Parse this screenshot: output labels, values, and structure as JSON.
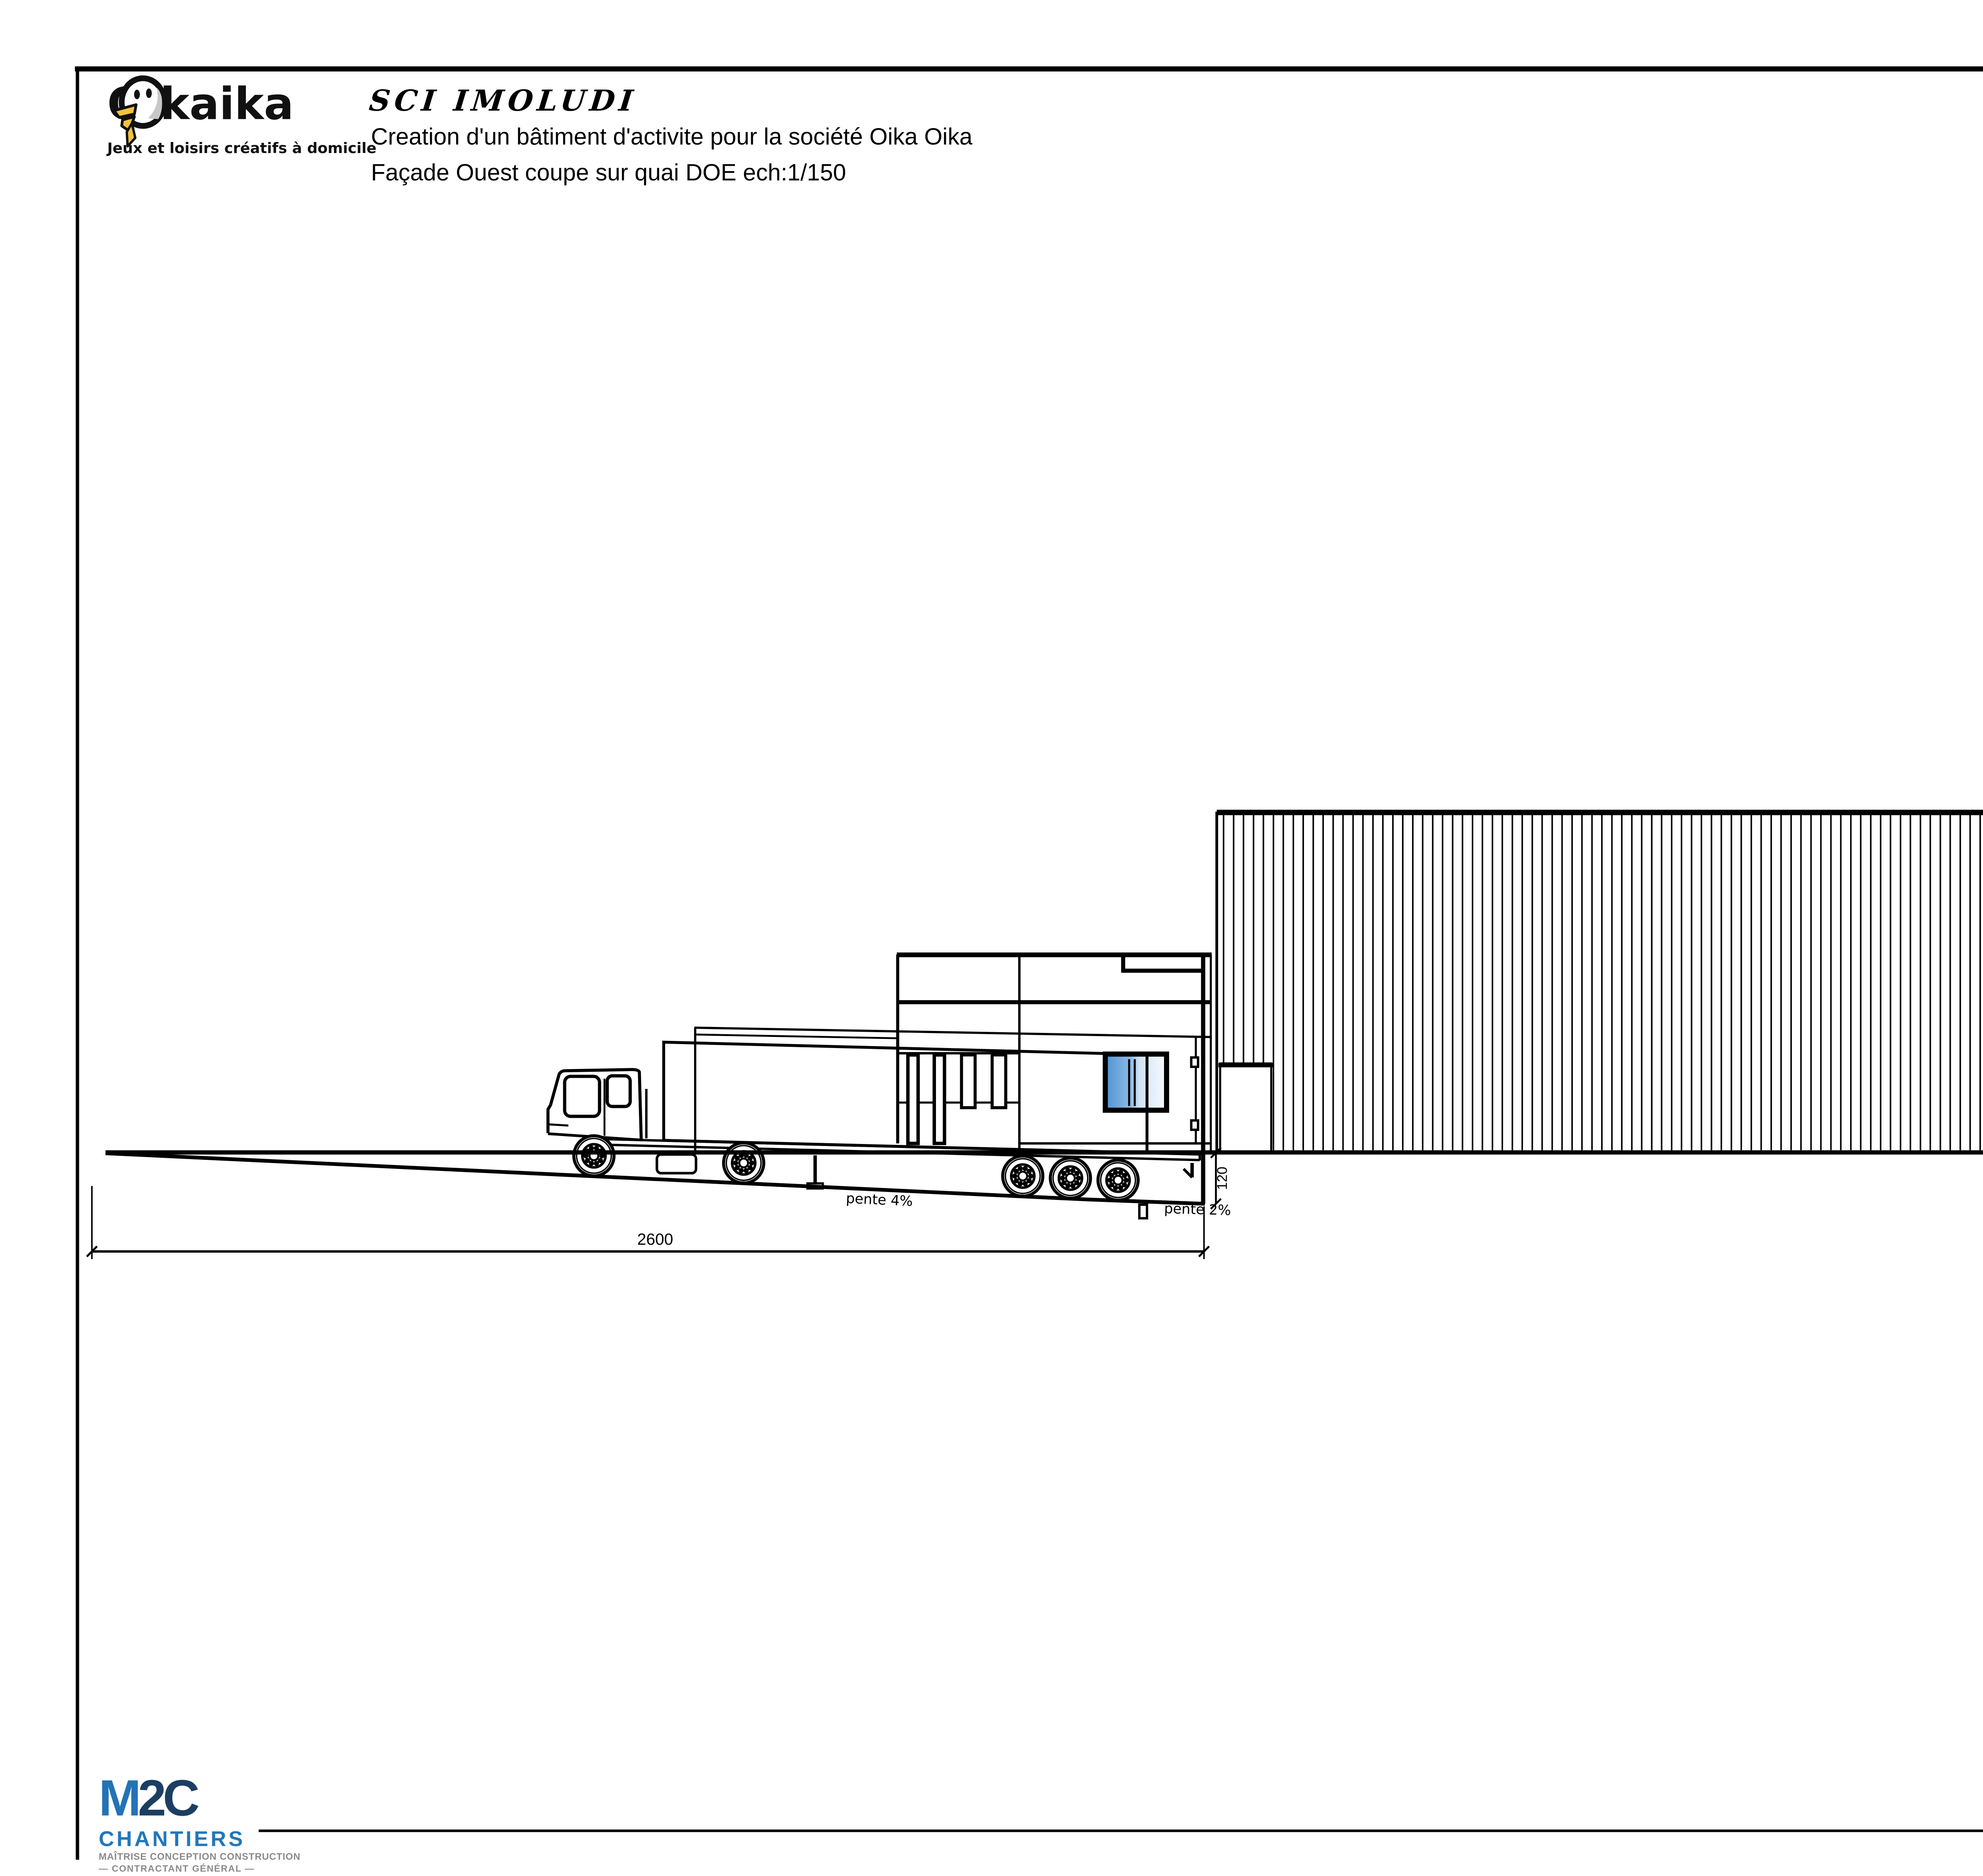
{
  "header": {
    "logo": {
      "word1": "Oika",
      "word2_suffix": "ika",
      "tagline": "Jeux et loisirs créatifs à domicile"
    },
    "title": {
      "client": "SCI IMOLUDI",
      "line1": "Creation d'un bâtiment d'activite pour la société Oika Oika",
      "line2": "Façade Ouest coupe sur quai DOE  ech:1/150"
    }
  },
  "drawing": {
    "dimensions": {
      "quai_length": "2600",
      "dock_height": "120",
      "canopy_width": "500",
      "building_height": "814",
      "canopy_clear_height": "460.5"
    },
    "slopes": {
      "ramp": "pente 4%",
      "dock": "pente 2%"
    },
    "colors": {
      "line": "#000000",
      "glazing_blue": "#4f93d4",
      "accent_blue": "#2b72b8"
    }
  },
  "footer": {
    "m2c": {
      "m": "M",
      "two": "2",
      "c": "C",
      "chantiers": "CHANTIERS",
      "subtitle1": "MAÎTRISE CONCEPTION CONSTRUCTION",
      "subtitle2": "— CONTRACTANT GÉNÉRAL —"
    },
    "date": "le 5 mars 2019"
  }
}
